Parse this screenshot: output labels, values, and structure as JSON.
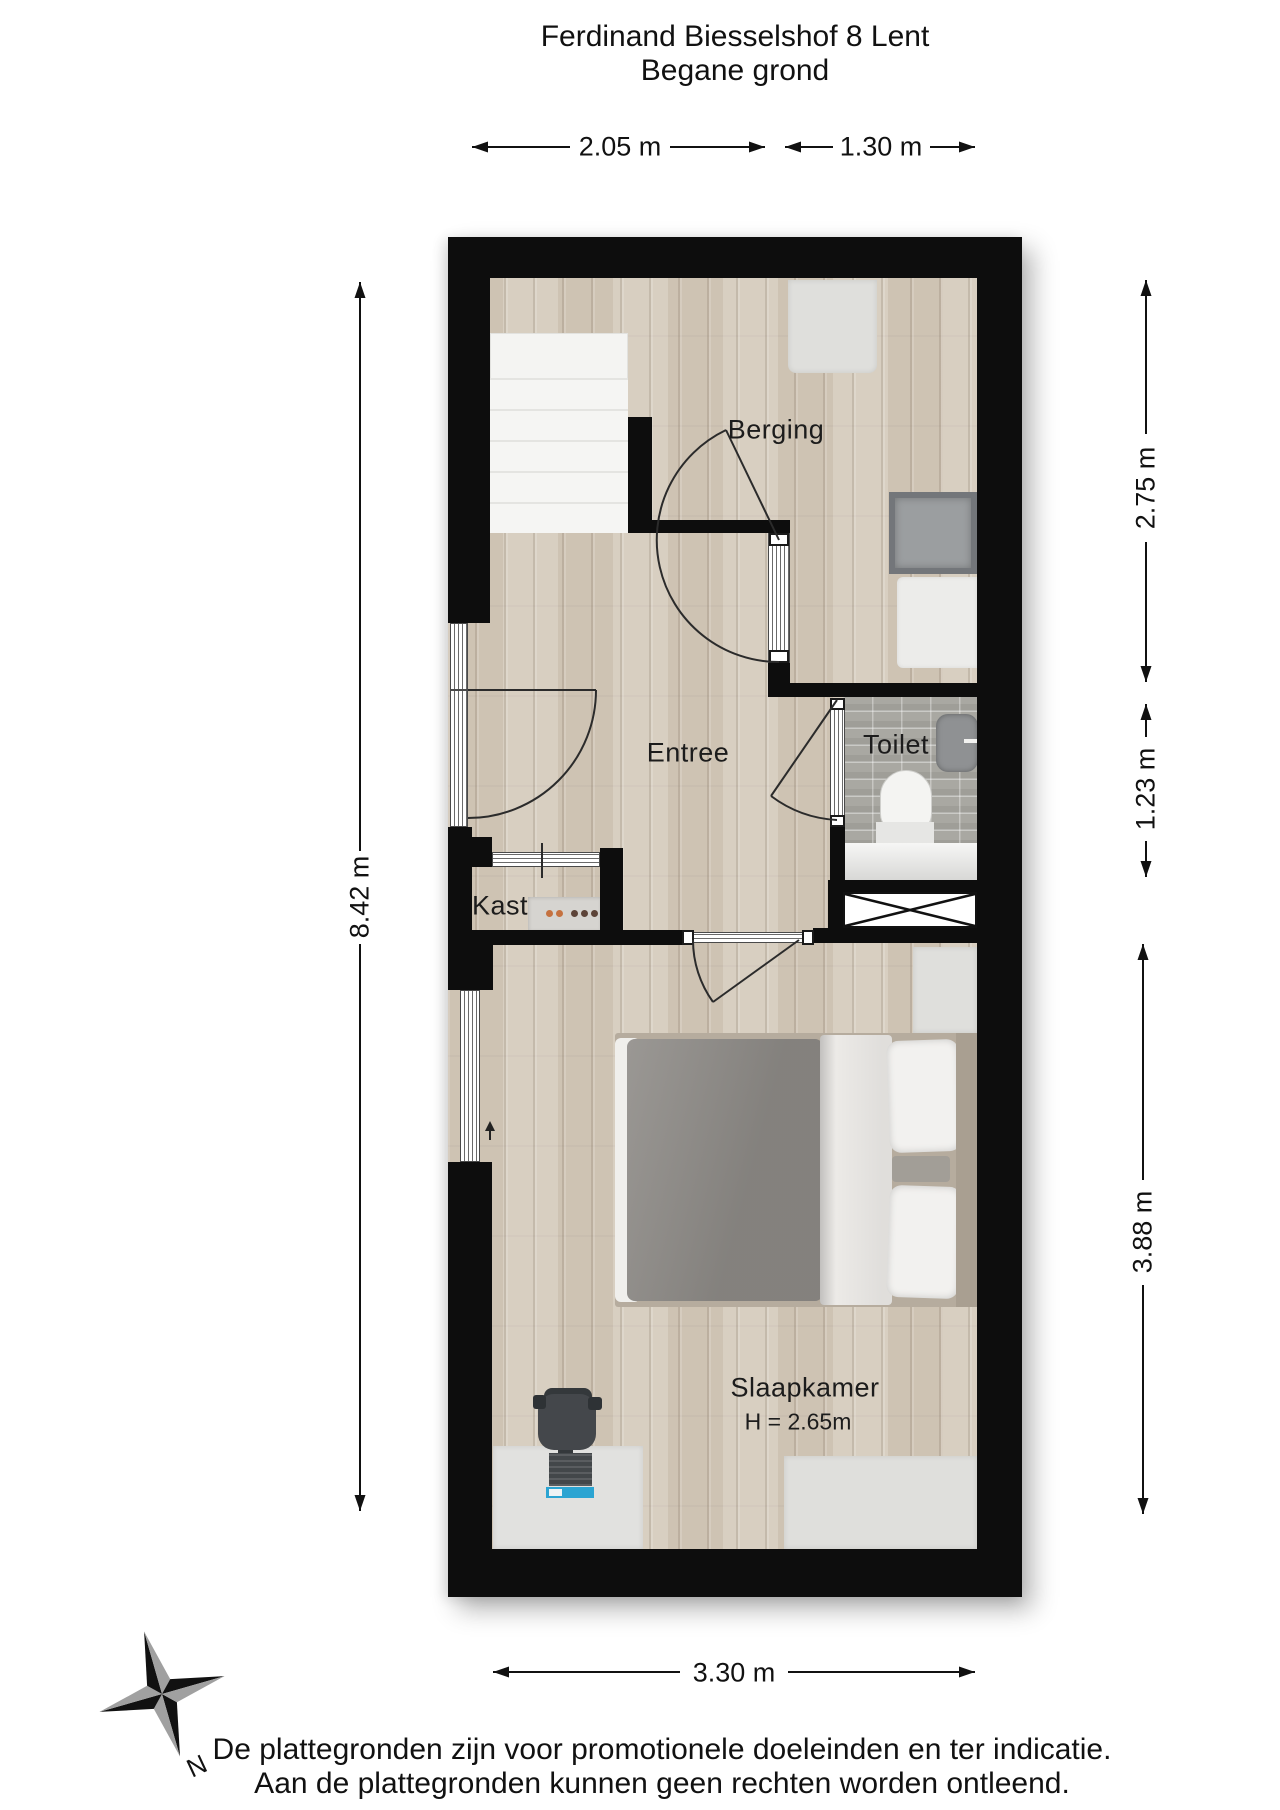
{
  "title": {
    "line1": "Ferdinand Biesselshof 8 Lent",
    "line2": "Begane grond"
  },
  "rooms": {
    "berging": {
      "label": "Berging"
    },
    "entree": {
      "label": "Entree"
    },
    "toilet": {
      "label": "Toilet"
    },
    "kast": {
      "label": "Kast"
    },
    "slaapkamer": {
      "label": "Slaapkamer",
      "height_note": "H = 2.65m"
    }
  },
  "dimensions": {
    "top_left": "2.05 m",
    "top_right": "1.30 m",
    "left": "8.42 m",
    "right_top": "2.75 m",
    "right_middle": "1.23 m",
    "right_bottom": "3.88 m",
    "bottom": "3.30 m"
  },
  "compass": {
    "north_label": "N"
  },
  "disclaimer": {
    "line1": "De plattegronden zijn voor promotionele doeleinden en ter indicatie.",
    "line2": "Aan de plattegronden kunnen geen rechten worden ontleend."
  },
  "colors": {
    "wall": "#0d0d0d",
    "wood_floor": "#d5cbbc",
    "tile_floor": "#a9a8a2",
    "accent_blue": "#2ba4d2"
  }
}
